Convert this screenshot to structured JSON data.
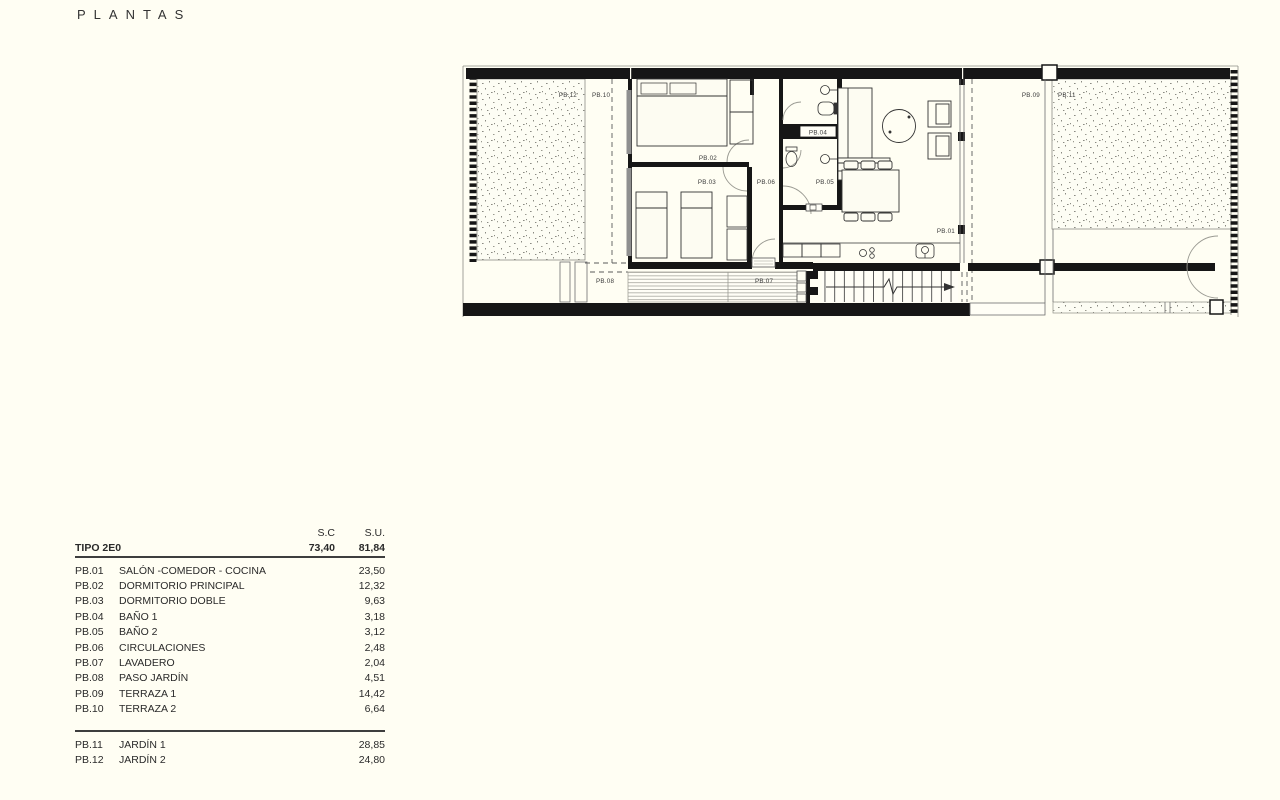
{
  "page": {
    "title": "PLANTAS",
    "background": "#fffef3"
  },
  "plan": {
    "labels": {
      "pb01": "PB.01",
      "pb02": "PB.02",
      "pb03": "PB.03",
      "pb04": "PB.04",
      "pb05": "PB.05",
      "pb06": "PB.06",
      "pb07": "PB.07",
      "pb08": "PB.08",
      "pb09": "PB.09",
      "pb10": "PB.10",
      "pb11": "PB.11",
      "pb12": "PB.12"
    },
    "colors": {
      "wall": "#161616",
      "thin_line": "#6e6e6e",
      "stipple": "#8a8a82",
      "window_glass": "#8f8f8f"
    }
  },
  "table": {
    "headers": {
      "sc": "S.C",
      "su": "S.U."
    },
    "type_row": {
      "label": "TIPO 2E0",
      "sc": "73,40",
      "su": "81,84"
    },
    "rows": [
      {
        "code": "PB.01",
        "name": "SALÓN -COMEDOR - COCINA",
        "su": "23,50"
      },
      {
        "code": "PB.02",
        "name": "DORMITORIO PRINCIPAL",
        "su": "12,32"
      },
      {
        "code": "PB.03",
        "name": "DORMITORIO DOBLE",
        "su": "9,63"
      },
      {
        "code": "PB.04",
        "name": "BAÑO 1",
        "su": "3,18"
      },
      {
        "code": "PB.05",
        "name": "BAÑO 2",
        "su": "3,12"
      },
      {
        "code": "PB.06",
        "name": "CIRCULACIONES",
        "su": "2,48"
      },
      {
        "code": "PB.07",
        "name": "LAVADERO",
        "su": "2,04"
      },
      {
        "code": "PB.08",
        "name": "PASO JARDÍN",
        "su": "4,51"
      },
      {
        "code": "PB.09",
        "name": "TERRAZA 1",
        "su": "14,42"
      },
      {
        "code": "PB.10",
        "name": "TERRAZA 2",
        "su": "6,64"
      }
    ],
    "outdoor_rows": [
      {
        "code": "PB.11",
        "name": "JARDÍN 1",
        "su": "28,85"
      },
      {
        "code": "PB.12",
        "name": "JARDÍN 2",
        "su": "24,80"
      }
    ]
  }
}
